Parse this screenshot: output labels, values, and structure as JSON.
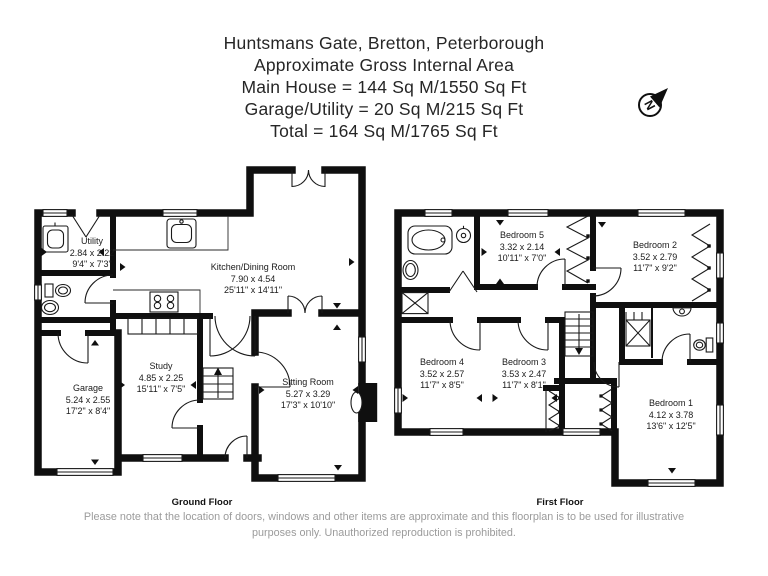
{
  "title": {
    "address": "Huntsmans Gate, Bretton, Peterborough",
    "subtitle": "Approximate Gross Internal Area",
    "main_house": "Main House = 144 Sq M/1550 Sq Ft",
    "garage_utility": "Garage/Utility = 20 Sq M/215 Sq Ft",
    "total": "Total = 164 Sq M/1765 Sq Ft"
  },
  "compass": {
    "icon": "north-arrow-icon",
    "letter": "N"
  },
  "ground_floor": {
    "label": "Ground Floor",
    "rooms": {
      "utility": {
        "name": "Utility",
        "metric": "2.84 x 2.22",
        "imperial": "9'4\" x 7'3\""
      },
      "kitchen": {
        "name": "Kitchen/Dining Room",
        "metric": "7.90 x 4.54",
        "imperial": "25'11\" x 14'11\""
      },
      "study": {
        "name": "Study",
        "metric": "4.85 x 2.25",
        "imperial": "15'11\" x 7'5\""
      },
      "garage": {
        "name": "Garage",
        "metric": "5.24 x 2.55",
        "imperial": "17'2\" x 8'4\""
      },
      "sitting": {
        "name": "Sitting Room",
        "metric": "5.27 x 3.29",
        "imperial": "17'3\" x 10'10\""
      }
    }
  },
  "first_floor": {
    "label": "First Floor",
    "rooms": {
      "bedroom5": {
        "name": "Bedroom 5",
        "metric": "3.32 x 2.14",
        "imperial": "10'11\" x 7'0\""
      },
      "bedroom2": {
        "name": "Bedroom 2",
        "metric": "3.52 x 2.79",
        "imperial": "11'7\" x 9'2\""
      },
      "bedroom4": {
        "name": "Bedroom 4",
        "metric": "3.52 x 2.57",
        "imperial": "11'7\" x 8'5\""
      },
      "bedroom3": {
        "name": "Bedroom 3",
        "metric": "3.53 x 2.47",
        "imperial": "11'7\" x 8'1\""
      },
      "bedroom1": {
        "name": "Bedroom 1",
        "metric": "4.12 x 3.78",
        "imperial": "13'6\" x 12'5\""
      }
    }
  },
  "disclaimer": {
    "line1": "Please note that the location of doors, windows and other items are approximate and this floorplan is to be used for illustrative",
    "line2": "purposes only. Unauthorized reproduction is prohibited."
  },
  "colors": {
    "wall": "#0f0f0f",
    "label_text": "#1b1b1b",
    "title_text": "#262626",
    "muted_text": "#9b9b9b"
  }
}
